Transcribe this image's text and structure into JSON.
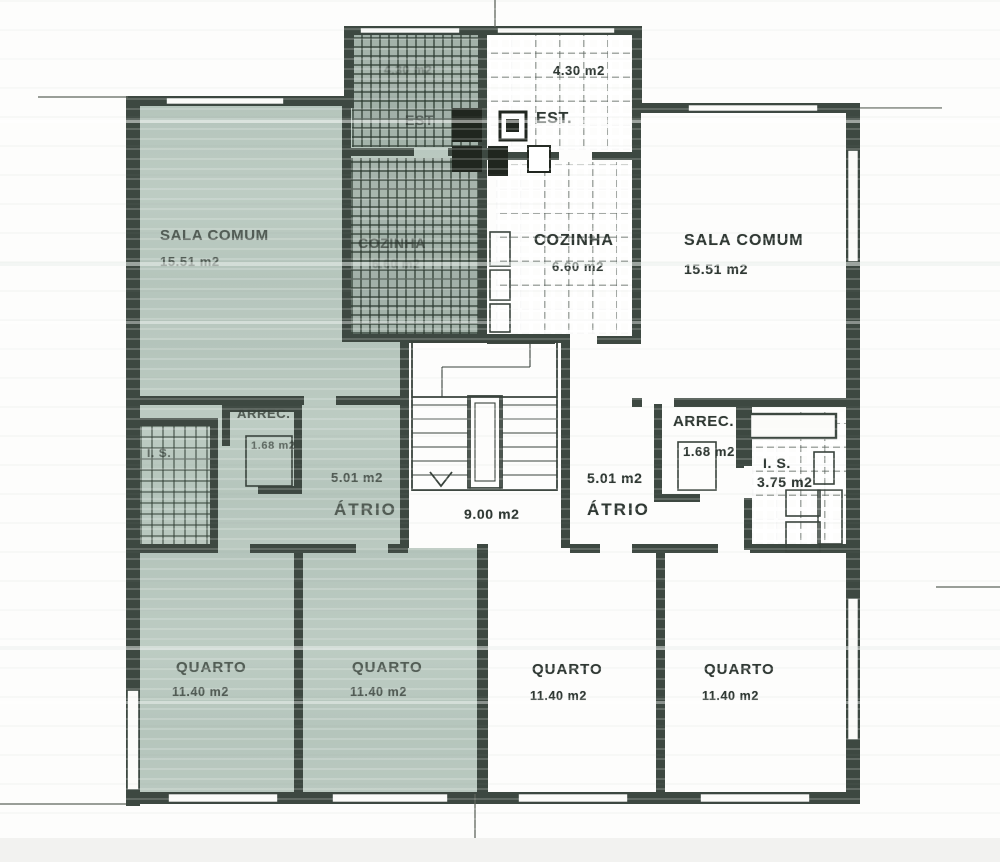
{
  "colors": {
    "paper": "#fdfdfc",
    "wall": "#3d4841",
    "tint": "#b9c8bf",
    "line": "#39433c"
  },
  "rooms": {
    "left_sala": {
      "name": "SALA COMUM",
      "area": "15.51 m2"
    },
    "left_cozinha": {
      "name": "COZINHA",
      "area": "6.60 m2"
    },
    "left_est": {
      "name": "EST",
      "area": "4.30 m2"
    },
    "left_arrec": {
      "name": "ARREC.",
      "area": "1.68 m2"
    },
    "left_is": {
      "name": "I. S."
    },
    "left_atrio": {
      "name": "ÁTRIO",
      "area": "5.01 m2"
    },
    "left_quarto_1": {
      "name": "QUARTO",
      "area": "11.40 m2"
    },
    "left_quarto_2": {
      "name": "QUARTO",
      "area": "11.40 m2"
    },
    "right_est": {
      "name": "EST.",
      "area": "4.30 m2"
    },
    "right_cozinha": {
      "name": "COZINHA",
      "area": "6.60 m2"
    },
    "right_sala": {
      "name": "SALA COMUM",
      "area": "15.51 m2"
    },
    "right_arrec": {
      "name": "ARREC.",
      "area": "1.68 m2"
    },
    "right_is": {
      "name": "I. S.",
      "area": "3.75 m2"
    },
    "right_atrio": {
      "name": "ÁTRIO",
      "area": "5.01 m2"
    },
    "right_quarto_1": {
      "name": "QUARTO",
      "area": "11.40 m2"
    },
    "right_quarto_2": {
      "name": "QUARTO",
      "area": "11.40 m2"
    },
    "stairwell": {
      "area": "9.00 m2"
    }
  }
}
